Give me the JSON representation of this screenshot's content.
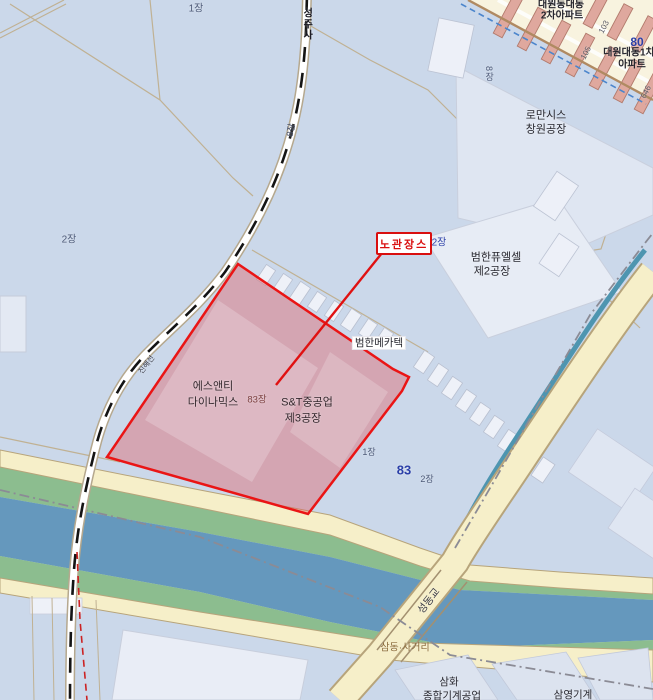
{
  "map": {
    "annotation": {
      "text": "노관장스",
      "color": "#d90f0f"
    },
    "selected_parcel": {
      "names": [
        "에스앤티 다이나믹스",
        "S&T중공업 제3공장"
      ],
      "sheet": "83장"
    },
    "labels": [
      {
        "id": "sheet-1-top",
        "text": "1장",
        "x": 196,
        "y": 9,
        "size": 10,
        "color": "#4d5a78"
      },
      {
        "id": "sheet-2-left",
        "text": "2장",
        "x": 69,
        "y": 240,
        "size": 10,
        "color": "#4d5a78"
      },
      {
        "id": "sheet-8-rail",
        "text": "8장",
        "x": 291,
        "y": 130,
        "size": 9,
        "color": "#3c4660",
        "rotate": -78
      },
      {
        "id": "rail-station",
        "text": "성주사",
        "x": 306,
        "y": 24,
        "size": 10,
        "color": "#15151f",
        "bold": true,
        "vertical": true
      },
      {
        "id": "rail-line-name",
        "text": "진해선",
        "x": 147,
        "y": 365,
        "size": 7.5,
        "color": "#3a3a46",
        "rotate": -52
      },
      {
        "id": "apt2-line1",
        "text": "대원동대동",
        "x": 561,
        "y": 5,
        "size": 10,
        "color": "#26262e",
        "bold": true
      },
      {
        "id": "apt2-line2",
        "text": "2차아파트",
        "x": 562,
        "y": 16,
        "size": 10,
        "color": "#26262e",
        "bold": true
      },
      {
        "id": "apt1-line1",
        "text": "대원대동1차",
        "x": 629,
        "y": 53,
        "size": 10,
        "color": "#26262e",
        "bold": true
      },
      {
        "id": "apt1-line2",
        "text": "아파트",
        "x": 632,
        "y": 65,
        "size": 10,
        "color": "#26262e",
        "bold": true
      },
      {
        "id": "num-80",
        "text": "80",
        "x": 637,
        "y": 43,
        "size": 12,
        "color": "#2b3fa8",
        "bold": true
      },
      {
        "id": "bldg-103",
        "text": "103",
        "x": 604,
        "y": 27,
        "size": 8,
        "color": "#5a5a64",
        "rotate": -62
      },
      {
        "id": "bldg-105",
        "text": "105",
        "x": 586,
        "y": 53,
        "size": 8,
        "color": "#5a5a64",
        "rotate": -62
      },
      {
        "id": "bldg-106",
        "text": "646",
        "x": 646,
        "y": 92,
        "size": 8,
        "color": "#5a5a64",
        "rotate": -62
      },
      {
        "id": "sheet-8-right",
        "text": "8장",
        "x": 489,
        "y": 74,
        "size": 9,
        "color": "#4d5a78",
        "vertical": true
      },
      {
        "id": "romansis-line1",
        "text": "로만시스",
        "x": 546,
        "y": 116,
        "size": 11,
        "color": "#26262e"
      },
      {
        "id": "romansis-line2",
        "text": "창원공장",
        "x": 546,
        "y": 130,
        "size": 11,
        "color": "#26262e"
      },
      {
        "id": "sheet-2-annot",
        "text": "2장",
        "x": 439,
        "y": 243,
        "size": 10,
        "color": "#2b3fa8"
      },
      {
        "id": "fuelcell-line1",
        "text": "범한퓨엘셀",
        "x": 496,
        "y": 258,
        "size": 11,
        "color": "#26262e"
      },
      {
        "id": "fuelcell-line2",
        "text": "제2공장",
        "x": 492,
        "y": 272,
        "size": 11,
        "color": "#26262e"
      },
      {
        "id": "mecatec",
        "text": "범한메카텍",
        "x": 379,
        "y": 343,
        "size": 10.5,
        "color": "#26262e",
        "chip": true
      },
      {
        "id": "snt-dyn-line1",
        "text": "에스앤티",
        "x": 213,
        "y": 387,
        "size": 11,
        "color": "#33272c"
      },
      {
        "id": "snt-dyn-line2",
        "text": "다이나믹스",
        "x": 213,
        "y": 403,
        "size": 11,
        "color": "#33272c"
      },
      {
        "id": "sheet-83-red",
        "text": "83장",
        "x": 257,
        "y": 401,
        "size": 9.5,
        "color": "#7c4040"
      },
      {
        "id": "snt-heavy-line1",
        "text": "S&T중공업",
        "x": 307,
        "y": 403,
        "size": 11,
        "color": "#33272c"
      },
      {
        "id": "snt-heavy-line2",
        "text": "제3공장",
        "x": 303,
        "y": 419,
        "size": 11,
        "color": "#33272c"
      },
      {
        "id": "sheet-1-mid",
        "text": "1장",
        "x": 369,
        "y": 452,
        "size": 9,
        "color": "#4d5a78"
      },
      {
        "id": "num-83",
        "text": "83",
        "x": 404,
        "y": 471,
        "size": 13,
        "color": "#2b3fa8",
        "bold": true
      },
      {
        "id": "sheet-2-mid",
        "text": "2장",
        "x": 427,
        "y": 479,
        "size": 9,
        "color": "#4d5a78"
      },
      {
        "id": "seongdong-bridge",
        "text": "성동교",
        "x": 429,
        "y": 601,
        "size": 10.5,
        "color": "#3a3a44",
        "rotate": -52
      },
      {
        "id": "samdong-junction",
        "text": "삼동·사거리",
        "x": 405,
        "y": 648,
        "size": 10,
        "color": "#8a6a3a"
      },
      {
        "id": "samhwa-line1",
        "text": "삼화",
        "x": 449,
        "y": 682,
        "size": 10.5,
        "color": "#26262e"
      },
      {
        "id": "samhwa-line2",
        "text": "종합기계공업",
        "x": 452,
        "y": 696,
        "size": 10.5,
        "color": "#26262e"
      },
      {
        "id": "samyoung",
        "text": "삼영기계",
        "x": 573,
        "y": 695,
        "size": 10.5,
        "color": "#26262e"
      }
    ],
    "colors": {
      "background": "#cbd8ea",
      "selection_fill": "#e05a5f",
      "selection_border": "#ea1515",
      "annotation_red": "#d90f0f",
      "road_yellow": "#f6efc9",
      "road_casing": "#b7a47b",
      "river_blue": "#6598bd",
      "bank_green": "#8cbd8f",
      "stream_teal": "#4e95b0",
      "railway_black": "#141414",
      "apartment_salmon": "#dfa89e",
      "apartment_ground": "#f8f3df",
      "building_light": "#e6ebf5",
      "parcel_line_tan": "#c0b193",
      "number_blue": "#2b3fa8"
    }
  }
}
